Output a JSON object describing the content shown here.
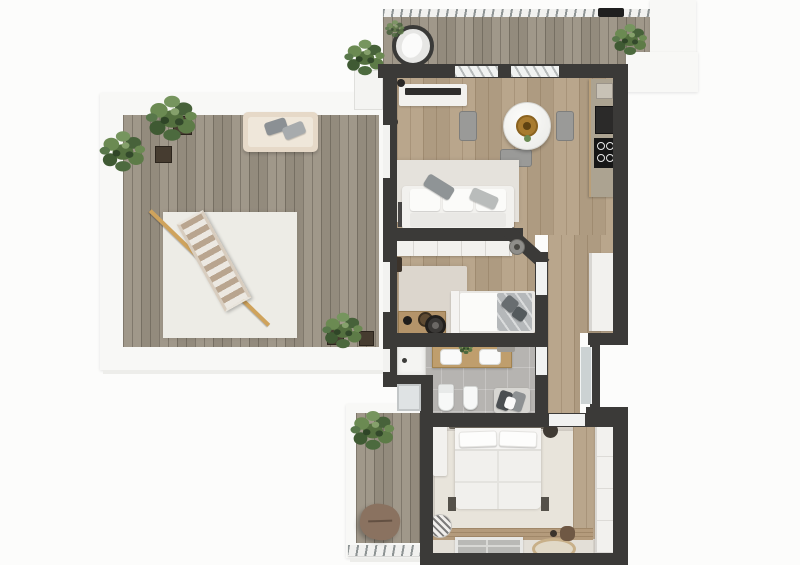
{
  "scene": {
    "type": "3d-floor-plan-top-view-render",
    "description": "Photorealistic top-down 3D floor plan of an apartment with large wrap terrace, top balcony, living room with open kitchen, single bedroom, bathroom, main bedroom and a small lower balcony",
    "visible_text": "none"
  },
  "palette": {
    "bg": "#fcfcfb",
    "wall": "#3b3a38",
    "parapet": "#f8f8f6",
    "deck": "#9b9284",
    "wood": "#b5a186",
    "woodBand": "#b49b7c",
    "tile": "#b6b4b1",
    "floorMain": "#d8d3cb",
    "furnWhite": "#f2f1ee",
    "rugTerrace": "#edece6",
    "rugLiving": "#e5e2dc",
    "rugBedroomSmall": "#dcd6cd",
    "rugBedroomMain": "#e8e4db",
    "counterGray": "#aca391",
    "cooktopBlack": "#161616",
    "goldTray": "#a87b2f",
    "loungerStripe": "#b9a58f",
    "pole": "#cfa35c",
    "plantGreen": "#54703f",
    "pillowGray": "#8f9496",
    "poufBrown": "#8a7260"
  },
  "rooms": [
    {
      "id": "terrace",
      "name": "large terrace",
      "floor": "wood decking",
      "features": [
        "white parapet",
        "outdoor rug",
        "striped sun lounger",
        "bench with cushions",
        "potted plants"
      ]
    },
    {
      "id": "top-balcony",
      "name": "top balcony",
      "floor": "wood decking",
      "features": [
        "glass railing",
        "egg chair",
        "planter box",
        "potted plant",
        "railing flower box"
      ]
    },
    {
      "id": "living-room",
      "name": "living room / open kitchen",
      "floor": "wood planks",
      "features": [
        "tv sideboard",
        "round dining table",
        "three chairs",
        "sofa with rug",
        "kitchen counter with cooktop and oven",
        "tall white cabinet"
      ]
    },
    {
      "id": "bedroom-small",
      "name": "single bedroom",
      "floor": "wood planks + rug",
      "features": [
        "wardrobe",
        "single bed with gray blanket",
        "desk",
        "round stool"
      ]
    },
    {
      "id": "bathroom",
      "name": "bathroom",
      "floor": "gray tile",
      "features": [
        "shower",
        "double vanity",
        "toilet",
        "bidet",
        "towel bench"
      ]
    },
    {
      "id": "bedroom-main",
      "name": "main bedroom",
      "floor": "greige + rug",
      "features": [
        "double bed",
        "nightstands",
        "wardrobe",
        "low table",
        "round jute rug"
      ]
    },
    {
      "id": "lower-balcony",
      "name": "small lower balcony",
      "floor": "wood decking",
      "features": [
        "plant",
        "floor pouf",
        "railing"
      ]
    }
  ],
  "furniture_counts": {
    "plants": 8,
    "beds": 2,
    "sofas": 1,
    "tables": 2,
    "chairs": 4,
    "wardrobes": 3
  }
}
